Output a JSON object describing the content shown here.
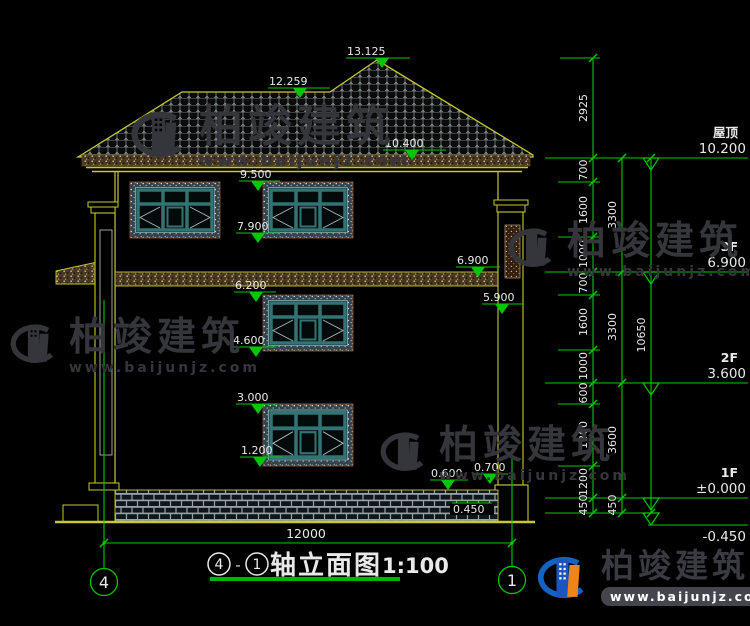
{
  "title": {
    "circle_left": "4",
    "dash": "-",
    "circle_right": "1",
    "label": "轴立面图",
    "scale": "1:100"
  },
  "axis_bubbles": {
    "left": "4",
    "right": "1"
  },
  "dims": {
    "overall": "12000",
    "inner": [
      "2925",
      "700",
      "1600",
      "1000",
      "700",
      "1600",
      "1000",
      "600",
      "1800",
      "1200",
      "450"
    ],
    "mid": [
      "3300",
      "3300",
      "3600",
      "450"
    ],
    "outer": [
      "10650"
    ]
  },
  "spots": [
    "13.125",
    "12.259",
    "10.400",
    "9.500",
    "7.900",
    "6.900",
    "6.200",
    "5.900",
    "4.600",
    "3.000",
    "1.200",
    "0.600",
    "0.700",
    "0.450"
  ],
  "levels": [
    {
      "name": "屋顶",
      "value": "10.200"
    },
    {
      "name": "3F",
      "value": "6.900"
    },
    {
      "name": "2F",
      "value": "3.600"
    },
    {
      "name": "1F",
      "value": "±0.000"
    },
    {
      "name": "",
      "value": "-0.450"
    }
  ],
  "watermark": {
    "brand": "柏竣建筑",
    "url": "www.baijunjz.com"
  },
  "logo": {
    "brand": "柏竣建筑",
    "url": "www.baijunjz.com"
  },
  "colors": {
    "dim_green": "#00c800",
    "line_yellow": "#c8c832",
    "teal": "#327474"
  }
}
